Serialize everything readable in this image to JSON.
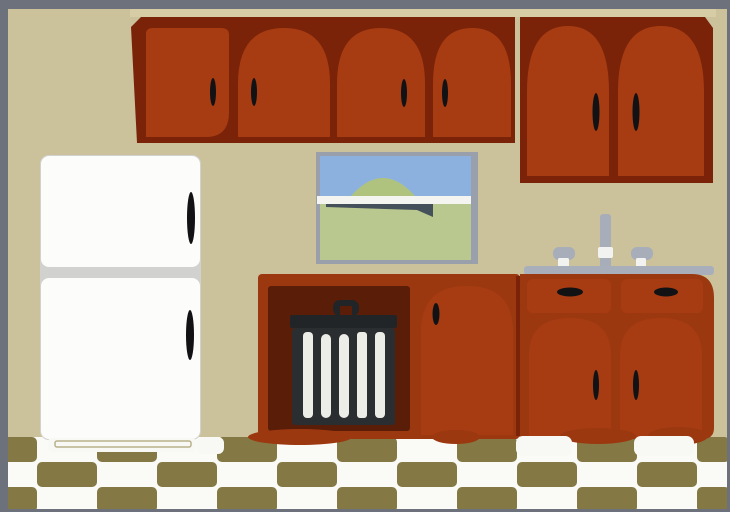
{
  "scene": {
    "type": "clipart illustration",
    "description": "Cartoon kitchen interior: dark red wooden upper and lower cabinets, white two-door refrigerator, window with sky and green hill, sink with faucet and two knobs, black striped trash can in an open alcove, olive-and-white checkered floor, gray picture border",
    "width_px": 730,
    "height_px": 512
  },
  "labels": {
    "wall": "Kitchen wall",
    "floor": "Checkered kitchen floor",
    "border": "Gray picture border",
    "upper_cabinets_left": "Upper cabinet run (four arched doors)",
    "upper_cabinets_right": "Tall upper cabinet (two arched doors)",
    "cornice": "Cabinet cornice trim",
    "refrigerator": "White two-door refrigerator",
    "window": "Window with sky, hill and field",
    "sink": "Sink counter with faucet and knobs",
    "sink_base_cabinet": "Sink base cabinet with two drawers and two doors",
    "trash_cabinet": "Open base cabinet with trash can",
    "trash_can": "Black trash can with white stripes"
  },
  "colors": {
    "border": "#6D717C",
    "wall": "#CBC29C",
    "cornice": "#D6CDA7",
    "cabinet_frame": "#7B2309",
    "cabinet_door": "#A73C12",
    "cabinet_base": "#9C3810",
    "alcove": "#5A1D07",
    "handle": "#121214",
    "trash_body": "#2B2E30",
    "trash_lid": "#222527",
    "trash_stripe": "#EDEDE8",
    "fridge_body": "#FCFCFA",
    "fridge_divider": "#D1D1CF",
    "window_frame": "#99A0AB",
    "window_sky": "#8CB1DF",
    "window_hill": "#AFC37E",
    "window_sash": "#F4F5F1",
    "window_field": "#B9C88F",
    "window_shadow": "#44505A",
    "counter": "#A9AFBA",
    "metal": "#A7ADB9",
    "metal_white": "#F2F3F0",
    "floor_white": "#FAFAF6",
    "floor_olive": "#847944",
    "foot": "#F8F8F4"
  }
}
